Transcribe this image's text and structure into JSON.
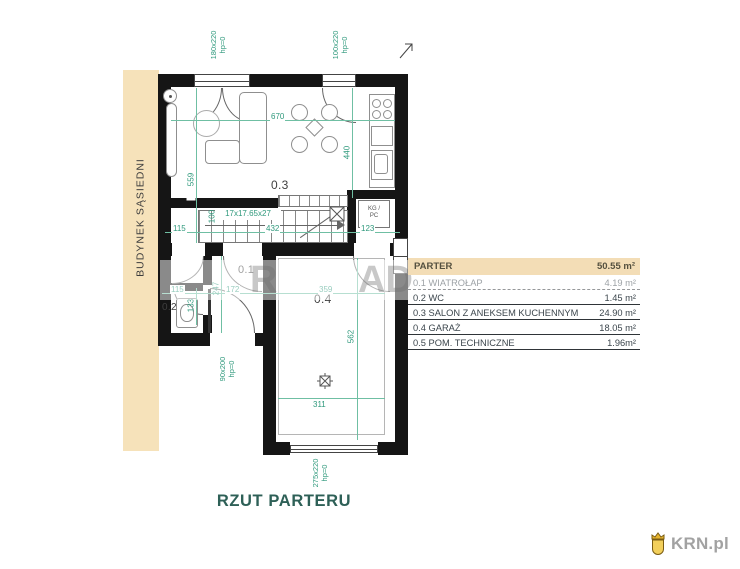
{
  "plan": {
    "title": "RZUT PARTERU",
    "neighbor_building": "BUDYNEK SĄSIEDNI",
    "rooms": {
      "r01": "0.1",
      "r02": "0.2",
      "r03": "0.3",
      "r04": "0.4"
    },
    "stairs": "17x17.65x27",
    "boiler_top": "KG /",
    "boiler_bottom": "PC",
    "dims": {
      "d670": "670",
      "d559": "559",
      "d440": "440",
      "d115a": "115",
      "d100": "100",
      "d432": "432",
      "d123": "123",
      "d115b": "115",
      "d247": "247",
      "d172": "172",
      "d359": "359",
      "d133": "133",
      "d562": "562",
      "d311": "311"
    },
    "openings": {
      "top_door": {
        "size": "180x220",
        "hp": "hp=0"
      },
      "kitchen_window": {
        "size": "100x220",
        "hp": "hp=0"
      },
      "entry_door": {
        "size": "90x200",
        "hp": "hp=0"
      },
      "garage_door": {
        "size": "275x220",
        "hp": "hp=0"
      }
    }
  },
  "legend": {
    "header": {
      "label": "PARTER",
      "area": "50.55 m²"
    },
    "rows": [
      {
        "num": "0.1",
        "name": "WIATROŁAP",
        "area": "4.19 m²"
      },
      {
        "num": "0.2",
        "name": "WC",
        "area": "1.45 m²"
      },
      {
        "num": "0.3",
        "name": "SALON Z ANEKSEM KUCHENNYM",
        "area": "24.90 m²"
      },
      {
        "num": "0.4",
        "name": "GARAŻ",
        "area": "18.05 m²"
      },
      {
        "num": "0.5",
        "name": "POM. TECHNICZNE",
        "area": "1.96m²"
      }
    ]
  },
  "watermark": {
    "left": "R",
    "right": "AD"
  },
  "logo": {
    "text": "KRN.pl"
  },
  "colors": {
    "dimension_green": "#2f997c",
    "wall_black": "#151515",
    "neighbor_beige": "#f6e2ba",
    "legend_header_beige": "#f3ddb6",
    "title_green": "#2e6057",
    "logo_gray": "#a2a2a2",
    "logo_gold": "#e7b52e"
  }
}
